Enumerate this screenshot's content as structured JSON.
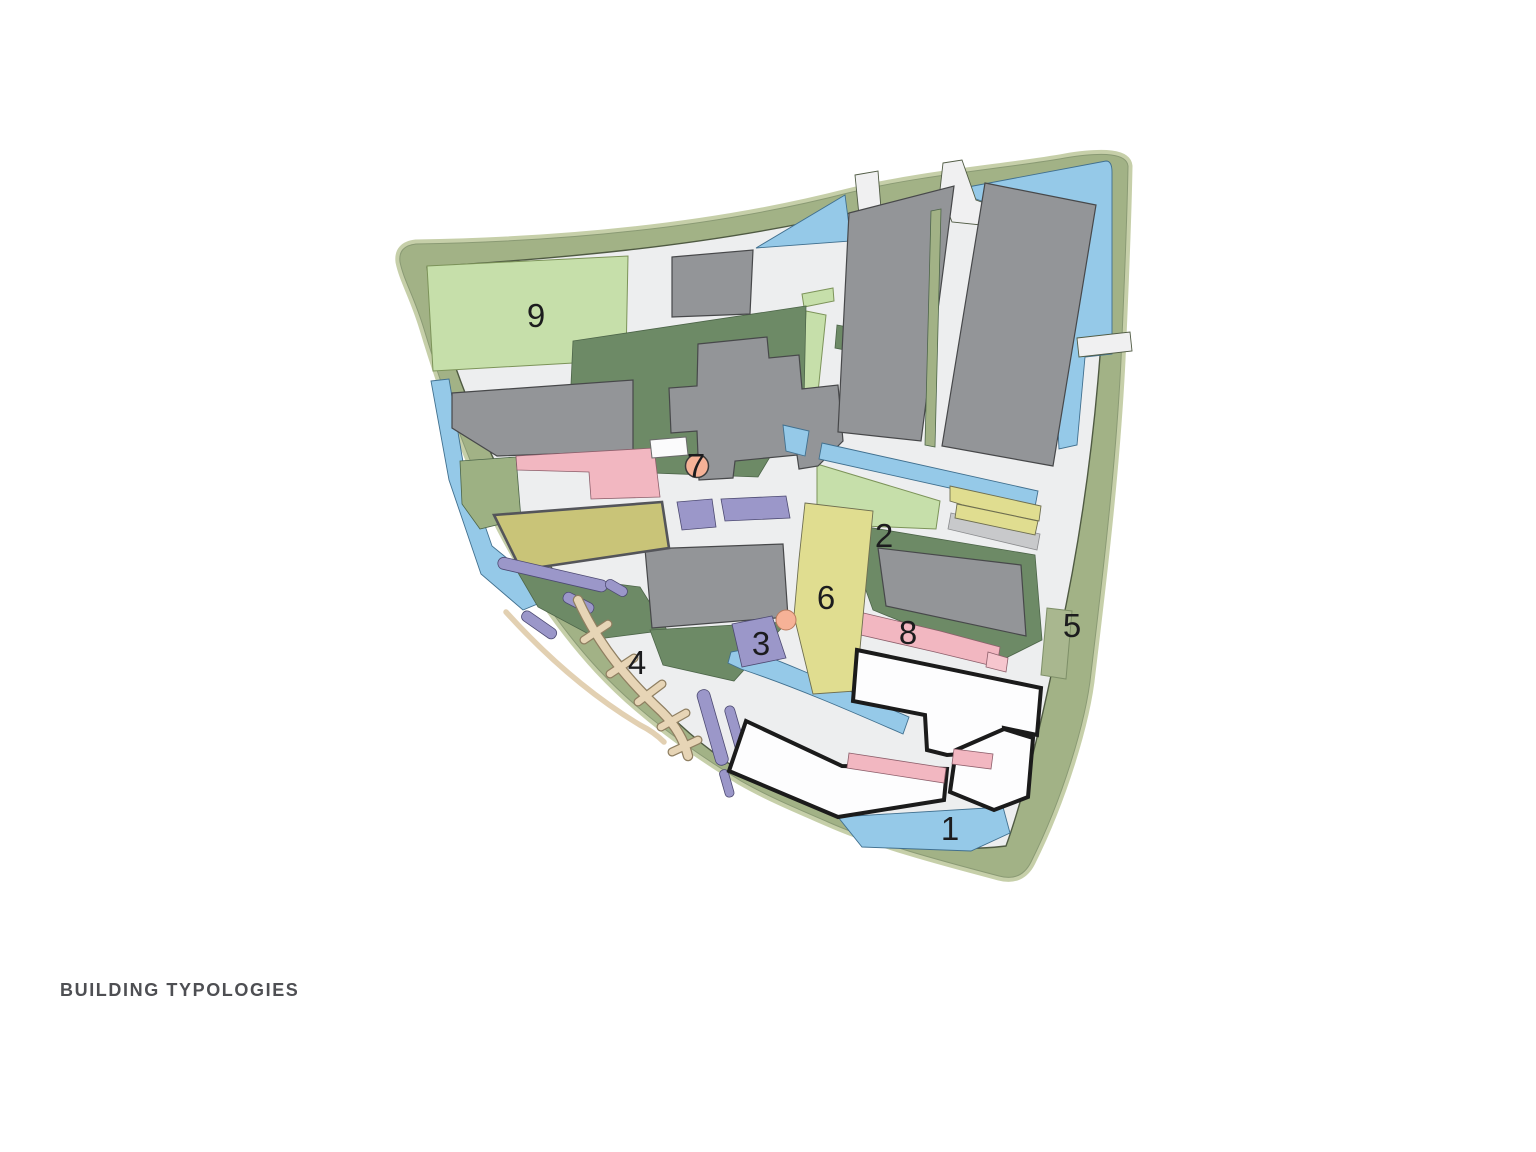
{
  "page": {
    "background": "#ffffff",
    "title": "BUILDING TYPOLOGIES"
  },
  "map": {
    "kind": "masterplan-building-typologies-diagram",
    "labels": [
      {
        "text": "1"
      },
      {
        "text": "2"
      },
      {
        "text": "3"
      },
      {
        "text": "4"
      },
      {
        "text": "5"
      },
      {
        "text": "6"
      },
      {
        "text": "7"
      },
      {
        "text": "8"
      },
      {
        "text": "9"
      }
    ],
    "palette": {
      "greenbelt": "#a2b286",
      "greenbelt_rim": "#c6cfa9",
      "street": "#edeeef",
      "park_dark_green": "#6d8a66",
      "lawn_light_green": "#c6dfaa",
      "sage_parcel": "#9db183",
      "water_blue": "#95c9e8",
      "building_gray": "#939598",
      "building_pink": "#f2b7c1",
      "building_pink_light": "#f6c6ce",
      "building_purple": "#9b97c9",
      "building_yellow": "#e0dd90",
      "building_khaki": "#c9c478",
      "building_white": "#fdfdfe",
      "pier_tan": "#e7d5b6",
      "marker_salmon": "#f6b297",
      "outline_black": "#1b1b1b",
      "label_text": "#1c1c1e",
      "title_text": "#4e4f53"
    }
  }
}
